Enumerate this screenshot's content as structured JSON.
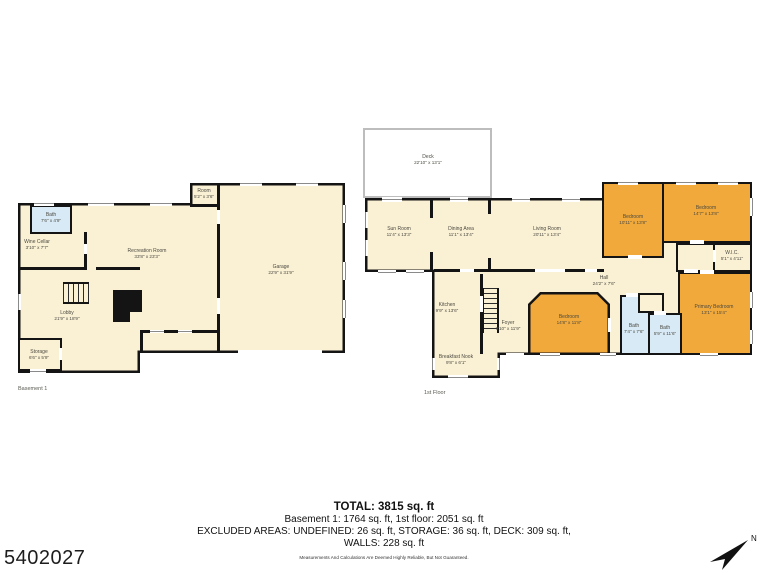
{
  "page": {
    "listing_id": "5402027",
    "north_label": "N"
  },
  "summary": {
    "total": "TOTAL: 3815 sq. ft",
    "line2": "Basement 1: 1764 sq. ft, 1st floor: 2051 sq. ft",
    "line3": "EXCLUDED AREAS: UNDEFINED: 26 sq. ft, STORAGE: 36 sq. ft, DECK: 309 sq. ft,",
    "line4": "WALLS: 228 sq. ft",
    "disclaimer": "Measurements And Calculations Are Deemed Highly Reliable, But Not Guaranteed."
  },
  "colors": {
    "wall": "#141414",
    "room_cream": "#FAF0D4",
    "room_orange": "#F2A93B",
    "room_blue": "#D8EAF6",
    "deck_border": "#BDBDBD",
    "window_line": "#8a8a8a"
  },
  "floors": [
    {
      "label": "Basement 1",
      "caption_pos": [
        18,
        386
      ],
      "underlays": [],
      "outline": {
        "outer": "18px 203px, 190px 203px, 190px 183px, 345px 183px, 345px 353px, 140px 353px, 140px 373px, 18px 373px",
        "inner": "20.5px 205.5px, 192.5px 205.5px, 192.5px 185.5px, 342.5px 185.5px, 342.5px 350.5px, 137.5px 350.5px, 137.5px 370.5px, 20.5px 370.5px",
        "fill": "cream"
      },
      "walls": [
        [
          217,
          185,
          3,
          166
        ],
        [
          190,
          204,
          30,
          3
        ],
        [
          84,
          232,
          3,
          38
        ],
        [
          20,
          267,
          66,
          3
        ],
        [
          96,
          267,
          44,
          3
        ],
        [
          140,
          330,
          78,
          3
        ],
        [
          140,
          330,
          3,
          23
        ]
      ],
      "rooms": [
        {
          "x": 30,
          "y": 205,
          "w": 42,
          "h": 29,
          "fill": "blue"
        },
        {
          "x": 18,
          "y": 338,
          "w": 44,
          "h": 33,
          "fill": "cream"
        }
      ],
      "polyrooms": [],
      "stairs": [
        {
          "x": 63,
          "y": 282,
          "w": 26,
          "h": 22,
          "dir": "h"
        }
      ],
      "solids": [
        [
          113,
          290,
          29,
          22
        ],
        [
          113,
          312,
          17,
          10
        ]
      ],
      "doors": [
        [
          217,
          210,
          3,
          14
        ],
        [
          217,
          298,
          3,
          16
        ],
        [
          238,
          350,
          84,
          4
        ],
        [
          59,
          348,
          3,
          12
        ],
        [
          84,
          244,
          3,
          10
        ]
      ],
      "windows": [
        {
          "x": 34,
          "y": 201,
          "w": 20,
          "h": 4.5,
          "o": "h"
        },
        {
          "x": 88,
          "y": 201,
          "w": 26,
          "h": 4.5,
          "o": "h"
        },
        {
          "x": 150,
          "y": 201,
          "w": 22,
          "h": 4.5,
          "o": "h"
        },
        {
          "x": 240,
          "y": 181,
          "w": 22,
          "h": 4.5,
          "o": "h"
        },
        {
          "x": 296,
          "y": 181,
          "w": 22,
          "h": 4.5,
          "o": "h"
        },
        {
          "x": 343,
          "y": 205,
          "w": 4.5,
          "h": 18,
          "o": "v"
        },
        {
          "x": 343,
          "y": 262,
          "w": 4.5,
          "h": 18,
          "o": "v"
        },
        {
          "x": 343,
          "y": 300,
          "w": 4.5,
          "h": 18,
          "o": "v"
        },
        {
          "x": 150,
          "y": 330,
          "w": 14,
          "h": 3,
          "o": "h"
        },
        {
          "x": 178,
          "y": 330,
          "w": 14,
          "h": 3,
          "o": "h"
        },
        {
          "x": 30,
          "y": 369,
          "w": 16,
          "h": 4.5,
          "o": "h"
        },
        {
          "x": 16,
          "y": 294,
          "w": 4.5,
          "h": 16,
          "o": "v"
        }
      ],
      "labels": [
        {
          "name": "Bath",
          "dims": "7'6\" x 4'9\"",
          "cx": 51,
          "cy": 218
        },
        {
          "name": "Wine Cellar",
          "dims": "3'10\" x 7'7\"",
          "cx": 37,
          "cy": 245
        },
        {
          "name": "Recreation Room",
          "dims": "33'8\" x 23'3\"",
          "cx": 147,
          "cy": 254
        },
        {
          "name": "Room",
          "dims": "5'2\" x 3'6\"",
          "cx": 204,
          "cy": 194
        },
        {
          "name": "Garage",
          "dims": "22'9\" x 31'9\"",
          "cx": 281,
          "cy": 270
        },
        {
          "name": "Lobby",
          "dims": "21'9\" x 18'9\"",
          "cx": 67,
          "cy": 316
        },
        {
          "name": "Storage",
          "dims": "6'6\" x 5'9\"",
          "cx": 39,
          "cy": 355
        }
      ]
    },
    {
      "label": "1st Floor",
      "caption_pos": [
        424,
        390
      ],
      "underlays": [
        {
          "x": 363,
          "y": 128,
          "w": 129,
          "h": 70,
          "fill": "white",
          "border": "deck"
        }
      ],
      "outline": {
        "outer": "365px 198px, 602px 198px, 602px 182px, 752px 182px, 752px 355px, 500px 355px, 500px 378px, 432px 378px, 432px 272px, 365px 272px",
        "inner": "367.5px 200.5px, 604.5px 200.5px, 604.5px 184.5px, 749.5px 184.5px, 749.5px 352.5px, 497.5px 352.5px, 497.5px 375.5px, 434.5px 375.5px, 434.5px 269.5px, 367.5px 269.5px",
        "fill": "cream"
      },
      "walls": [
        [
          434,
          269,
          170,
          3
        ],
        [
          430,
          200,
          3,
          18
        ],
        [
          430,
          252,
          3,
          20
        ],
        [
          488,
          200,
          3,
          14
        ],
        [
          488,
          258,
          3,
          14
        ],
        [
          480,
          274,
          3,
          80
        ]
      ],
      "rooms": [
        {
          "x": 602,
          "y": 182,
          "w": 62,
          "h": 76,
          "fill": "orange"
        },
        {
          "x": 662,
          "y": 182,
          "w": 90,
          "h": 61,
          "fill": "orange"
        },
        {
          "x": 713,
          "y": 243,
          "w": 39,
          "h": 29,
          "fill": "cream"
        },
        {
          "x": 676,
          "y": 243,
          "w": 39,
          "h": 29,
          "fill": "cream"
        },
        {
          "x": 678,
          "y": 272,
          "w": 74,
          "h": 83,
          "fill": "orange"
        },
        {
          "x": 620,
          "y": 295,
          "w": 30,
          "h": 60,
          "fill": "blue"
        },
        {
          "x": 648,
          "y": 313,
          "w": 34,
          "h": 42,
          "fill": "blue"
        },
        {
          "x": 638,
          "y": 293,
          "w": 26,
          "h": 20,
          "fill": "cream"
        }
      ],
      "polyrooms": [
        {
          "outer": "528px 304px, 540px 292px, 598px 292px, 610px 304px, 610px 355px, 528px 355px",
          "inner": "530.5px 305px, 541px 294.5px, 597px 294.5px, 607.5px 305px, 607.5px 352.5px, 530.5px 352.5px",
          "fill": "orange"
        }
      ],
      "stairs": [
        {
          "x": 482,
          "y": 288,
          "w": 17,
          "h": 45,
          "dir": "v"
        }
      ],
      "solids": [],
      "doors": [
        [
          628,
          255,
          14,
          4
        ],
        [
          690,
          240,
          14,
          4
        ],
        [
          713,
          250,
          3,
          12
        ],
        [
          684,
          269,
          14,
          4
        ],
        [
          700,
          270,
          14,
          4
        ],
        [
          626,
          293,
          12,
          4
        ],
        [
          654,
          311,
          12,
          4
        ],
        [
          608,
          318,
          3,
          14
        ],
        [
          460,
          269,
          14,
          3
        ],
        [
          535,
          269,
          30,
          3
        ],
        [
          585,
          269,
          12,
          3
        ],
        [
          480,
          296,
          3,
          16
        ],
        [
          506,
          353,
          18,
          4
        ]
      ],
      "windows": [
        {
          "x": 382,
          "y": 197,
          "w": 20,
          "h": 4.5,
          "o": "h"
        },
        {
          "x": 450,
          "y": 197,
          "w": 18,
          "h": 4.5,
          "o": "h"
        },
        {
          "x": 512,
          "y": 197,
          "w": 18,
          "h": 4.5,
          "o": "h"
        },
        {
          "x": 562,
          "y": 197,
          "w": 18,
          "h": 4.5,
          "o": "h"
        },
        {
          "x": 618,
          "y": 180,
          "w": 20,
          "h": 4.5,
          "o": "h"
        },
        {
          "x": 676,
          "y": 180,
          "w": 20,
          "h": 4.5,
          "o": "h"
        },
        {
          "x": 718,
          "y": 180,
          "w": 20,
          "h": 4.5,
          "o": "h"
        },
        {
          "x": 363,
          "y": 212,
          "w": 4.5,
          "h": 16,
          "o": "v"
        },
        {
          "x": 363,
          "y": 240,
          "w": 4.5,
          "h": 16,
          "o": "v"
        },
        {
          "x": 378,
          "y": 270,
          "w": 18,
          "h": 4.5,
          "o": "h"
        },
        {
          "x": 406,
          "y": 270,
          "w": 18,
          "h": 4.5,
          "o": "h"
        },
        {
          "x": 750,
          "y": 198,
          "w": 4.5,
          "h": 18,
          "o": "v"
        },
        {
          "x": 750,
          "y": 292,
          "w": 4.5,
          "h": 16,
          "o": "v"
        },
        {
          "x": 750,
          "y": 330,
          "w": 4.5,
          "h": 14,
          "o": "v"
        },
        {
          "x": 540,
          "y": 353,
          "w": 20,
          "h": 4.5,
          "o": "h"
        },
        {
          "x": 600,
          "y": 353,
          "w": 16,
          "h": 4.5,
          "o": "h"
        },
        {
          "x": 700,
          "y": 353,
          "w": 18,
          "h": 4.5,
          "o": "h"
        },
        {
          "x": 430,
          "y": 358,
          "w": 4.5,
          "h": 12,
          "o": "v"
        },
        {
          "x": 448,
          "y": 375,
          "w": 20,
          "h": 4.5,
          "o": "h"
        },
        {
          "x": 497,
          "y": 358,
          "w": 4.5,
          "h": 12,
          "o": "v"
        }
      ],
      "labels": [
        {
          "name": "Deck",
          "dims": "22'10\" x 13'1\"",
          "cx": 428,
          "cy": 160
        },
        {
          "name": "Sun Room",
          "dims": "11'4\" x 13'3\"",
          "cx": 399,
          "cy": 232
        },
        {
          "name": "Dining Area",
          "dims": "11'1\" x 13'4\"",
          "cx": 461,
          "cy": 232
        },
        {
          "name": "Living Room",
          "dims": "20'11\" x 13'4\"",
          "cx": 547,
          "cy": 232
        },
        {
          "name": "Bedroom",
          "dims": "10'11\" x 13'8\"",
          "cx": 633,
          "cy": 220
        },
        {
          "name": "Bedroom",
          "dims": "14'7\" x 13'8\"",
          "cx": 706,
          "cy": 211
        },
        {
          "name": "W.I.C.",
          "dims": "5'1\" x 4'11\"",
          "cx": 732,
          "cy": 256
        },
        {
          "name": "Hall",
          "dims": "24'2\" x 7'6\"",
          "cx": 604,
          "cy": 281
        },
        {
          "name": "Kitchen",
          "dims": "9'9\" x 13'6\"",
          "cx": 447,
          "cy": 308
        },
        {
          "name": "Foyer",
          "dims": "9'10\" x 11'9\"",
          "cx": 508,
          "cy": 326
        },
        {
          "name": "Bedroom",
          "dims": "14'8\" x 11'8\"",
          "cx": 569,
          "cy": 320
        },
        {
          "name": "Bath",
          "dims": "7'4\" x 7'6\"",
          "cx": 634,
          "cy": 329
        },
        {
          "name": "Bath",
          "dims": "5'9\" x 11'6\"",
          "cx": 665,
          "cy": 331
        },
        {
          "name": "Primary Bedroom",
          "dims": "13'1\" x 15'4\"",
          "cx": 714,
          "cy": 310
        },
        {
          "name": "Breakfast Nook",
          "dims": "9'8\" x 6'1\"",
          "cx": 456,
          "cy": 360
        }
      ]
    }
  ]
}
